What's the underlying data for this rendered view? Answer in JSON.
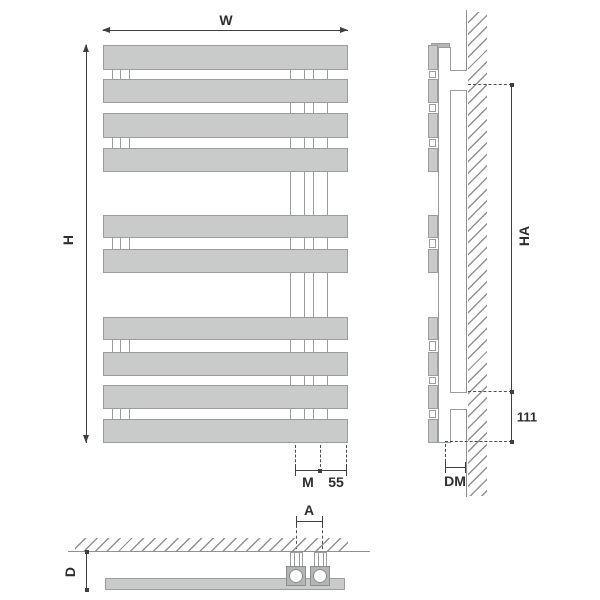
{
  "dimensions": {
    "front": {
      "width": "W",
      "height": "H",
      "m": "M",
      "spacing": "55"
    },
    "side": {
      "mounting_height": "HA",
      "bottom_clearance": "111",
      "wall_distance": "DM"
    },
    "bottom": {
      "pipe_spacing": "A",
      "depth": "D"
    }
  },
  "radiator": {
    "panels_total": 10,
    "panel_groups": [
      4,
      2,
      4
    ],
    "pipe_connections": 2
  },
  "colors": {
    "panel_fill": "#c8cbca",
    "panel_border": "#999d9c",
    "valve_fill": "#b3b6b5",
    "dimension_line": "#3f3f3f",
    "wall_line": "#8f9291",
    "background": "#ffffff"
  }
}
